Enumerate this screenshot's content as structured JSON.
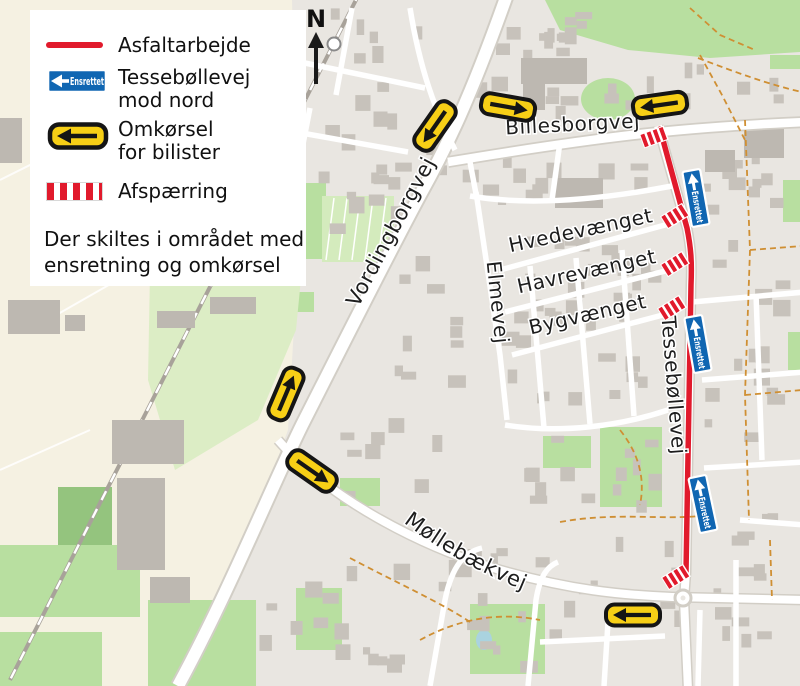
{
  "legend": {
    "asfalt_label": "Asfaltarbejde",
    "ensrettet_sign": "Ensrettet",
    "ensrettet_label_1": "Tessebøllevej",
    "ensrettet_label_2": "mod nord",
    "omkoersel_label_1": "Omkørsel",
    "omkoersel_label_2": "for bilister",
    "afspaerring_label": "Afspærring",
    "note_1": "Der skiltes i området med",
    "note_2": "ensretning og omkørsel"
  },
  "compass": {
    "north_label": "N"
  },
  "map": {
    "streets": [
      {
        "name": "Vordingborgvej"
      },
      {
        "name": "Billesborgvej"
      },
      {
        "name": "Hvedevænget"
      },
      {
        "name": "Havrevænget"
      },
      {
        "name": "Bygvænget"
      },
      {
        "name": "Elmevej"
      },
      {
        "name": "Tessebøllevej"
      },
      {
        "name": "Møllebækvej"
      }
    ],
    "onewaysign_text": "Ensrettet",
    "roadwork_line": "Tessebøllevej",
    "detour_arrows": [
      {
        "x": 435,
        "y": 126,
        "rot": -55
      },
      {
        "x": 508,
        "y": 107,
        "rot": 190
      },
      {
        "x": 660,
        "y": 105,
        "rot": -8
      },
      {
        "x": 286,
        "y": 394,
        "rot": 113
      },
      {
        "x": 312,
        "y": 471,
        "rot": 215
      },
      {
        "x": 633,
        "y": 615,
        "rot": 0
      }
    ],
    "oneway_signs": [
      {
        "x": 696,
        "y": 198,
        "rot": 80
      },
      {
        "x": 698,
        "y": 344,
        "rot": 80
      },
      {
        "x": 703,
        "y": 504,
        "rot": 78
      }
    ],
    "closures": [
      {
        "x": 654,
        "y": 137,
        "rot": -20
      },
      {
        "x": 675,
        "y": 216,
        "rot": -32
      },
      {
        "x": 675,
        "y": 264,
        "rot": -32
      },
      {
        "x": 672,
        "y": 308,
        "rot": -32
      },
      {
        "x": 676,
        "y": 577,
        "rot": -32
      }
    ]
  },
  "colors": {
    "roadwork_red": "#e11a2c",
    "detour_yellow": "#f7cf16",
    "detour_outline": "#151515",
    "oneway_blue": "#1066b2"
  }
}
